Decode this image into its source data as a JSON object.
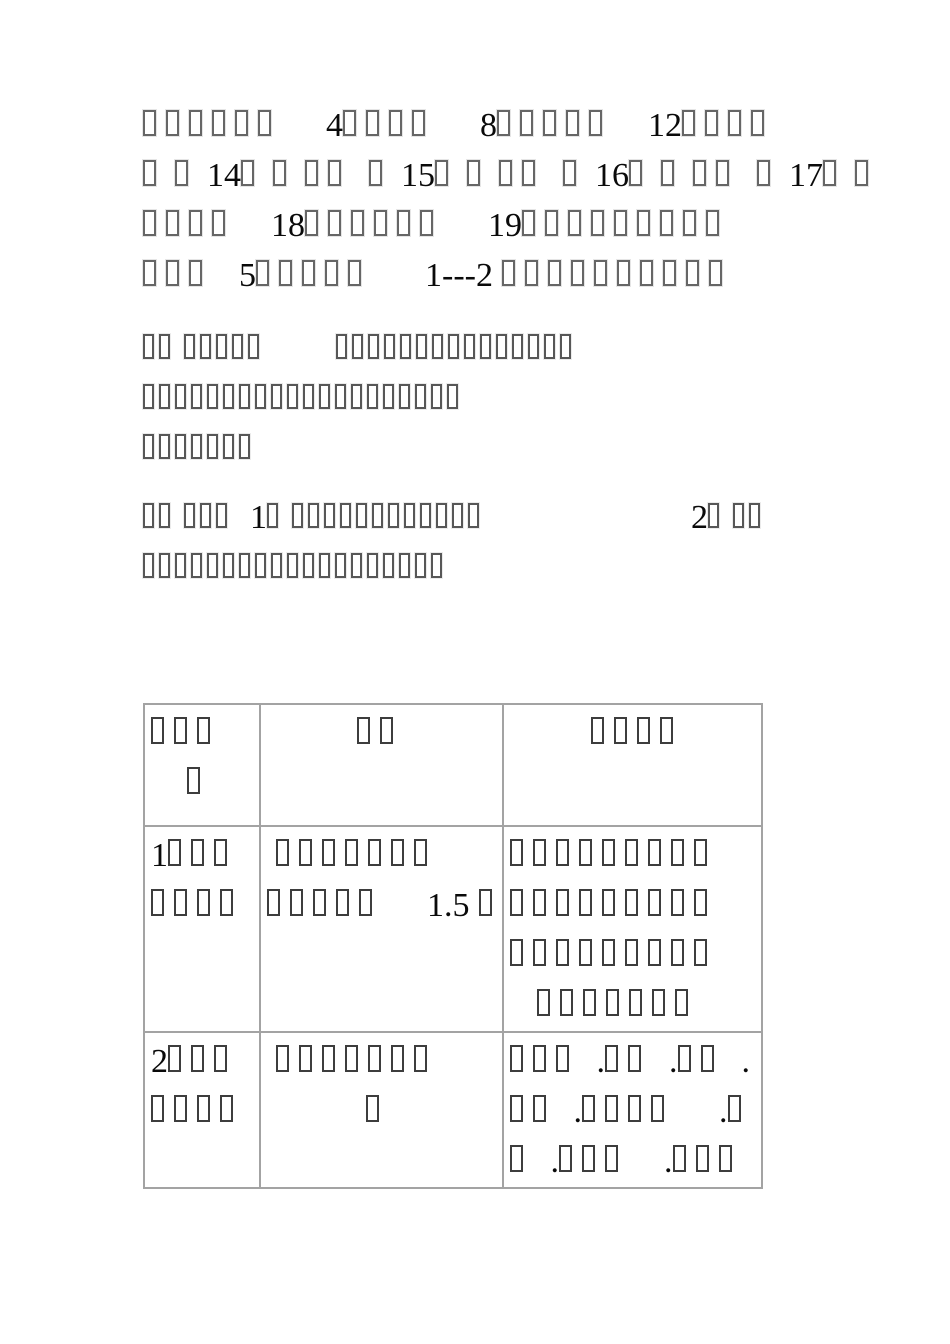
{
  "page": {
    "background": "#ffffff",
    "note": "document page with missing-glyph (tofu) CJK characters, serif numerals and a 3-column table"
  },
  "colors": {
    "paragraph_tofu_border": "#666666",
    "table_tofu_border": "#3d3d3d",
    "table_border": "#a3a3a3",
    "digit_color": "#0a0a0a"
  },
  "paragraphs": [
    {
      "lines": [
        "□□□□□□     4□□□□     8□□□□□    12□□□□",
        "□ □ 14□ □ □□  □ 15□ □ □□  □ 16□ □ □□  □ 17□ □",
        "□□□□    18□□□□□□     19□□□□□□□□□",
        "□□□   5□□□□□      1---2 □□□□□□□□□□"
      ]
    },
    {
      "lines": [
        "□□ □□□□□        □□□□□□□□□□□□□□□",
        "□□□□□□□□□□□□□□□□□□□□",
        "□□□□□□□"
      ]
    },
    {
      "lines": [
        "□□ □□□  1□ □□□□□□□□□□□□                       2□ □□",
        "□□□□□□□□□□□□□□□□□□□"
      ]
    }
  ],
  "table": {
    "rows": [
      {
        "cells": [
          {
            "lines": [
              "□□□",
              "    □"
            ]
          },
          {
            "lines": [
              "          □□"
            ]
          },
          {
            "lines": [
              "         □□□□"
            ]
          }
        ]
      },
      {
        "cells": [
          {
            "lines": [
              "1□□□",
              "□□□□"
            ]
          },
          {
            "lines": [
              " □□□□□□□",
              "□□□□□     1.5 □"
            ]
          },
          {
            "lines": [
              "□□□□□□□□□",
              "□□□□□□□□□",
              "□□□□□□□□□",
              "   □□□□□□□"
            ]
          }
        ]
      },
      {
        "cells": [
          {
            "lines": [
              "2□□□",
              "□□□□"
            ]
          },
          {
            "lines": [
              " □□□□□□□",
              "           □"
            ]
          },
          {
            "lines": [
              "□□□  .□□  .□□  .",
              "□□  .□□□□     .□",
              "□  .□□□    .□□□"
            ]
          }
        ]
      }
    ]
  }
}
